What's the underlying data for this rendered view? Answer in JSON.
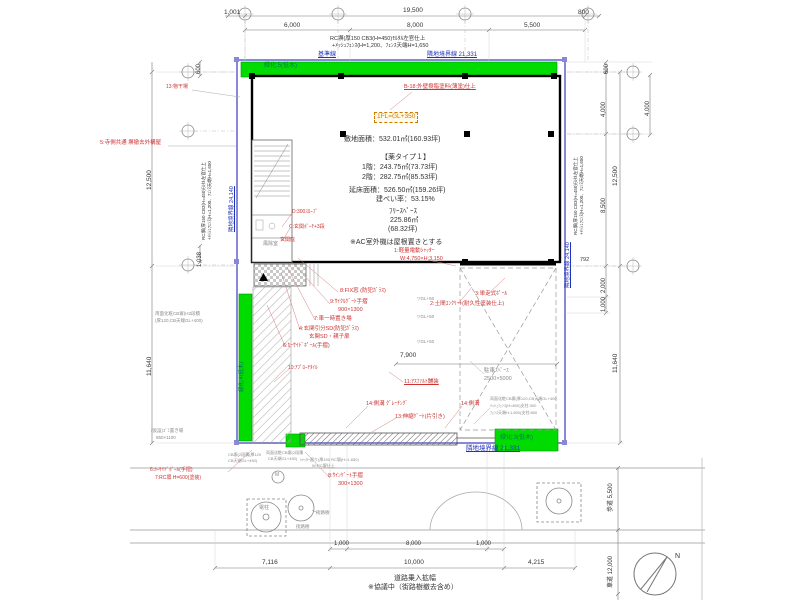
{
  "colors": {
    "ink": "#333333",
    "red": "#cc3333",
    "blue": "#2233bb",
    "teal": "#007755",
    "gray": "#8a8a8a",
    "orange": "#cc7a00",
    "green": "#00dc00",
    "green_edge": "#009900",
    "boundary": "#8888d8"
  },
  "plan_summary": {
    "site_area": "敷地面積：532.01㎡(160.93坪)",
    "plan_type": "【薬タイプ１】",
    "floor1": "1階：243.75㎡(73.73坪)",
    "floor2": "2階：282.75㎡(85.53坪)",
    "total_floor_area": "延床面積：526.50㎡(159.26坪)",
    "coverage_ratio": "建ぺい率：53.15%",
    "free_space": "ﾌﾘｰｽﾍﾟｰｽ 225.86㎡ (68.32坪)",
    "ac_note": "※AC室外機は屋根置きとする",
    "floor_level": "1FL=GL+350"
  },
  "labels": [
    {
      "n": "dim-top-1001",
      "t": "1,001",
      "x": 224,
      "y": 10,
      "s": 6.5
    },
    {
      "n": "dim-top-19500",
      "t": "19,500",
      "x": 403,
      "y": 8,
      "s": 6.5
    },
    {
      "n": "dim-top-800",
      "t": "800",
      "x": 578,
      "y": 10,
      "s": 6.5
    },
    {
      "n": "dim-top-6000",
      "t": "6,000",
      "x": 284,
      "y": 23,
      "s": 6.5
    },
    {
      "n": "dim-top-8000",
      "t": "8,000",
      "x": 407,
      "y": 23,
      "s": 6.5
    },
    {
      "n": "dim-top-5500",
      "t": "5,500",
      "x": 524,
      "y": 23,
      "s": 6.5
    },
    {
      "n": "note-wall-top-1",
      "t": "RC塀(厚150 CB3(H=450)ﾓﾙﾀﾙ左官仕上",
      "x": 330,
      "y": 37,
      "s": 5.5
    },
    {
      "n": "note-wall-top-2",
      "t": "+ﾒｯｼｭﾌｪﾝｽ(H=1,200、ﾌｪﾝｽ天端H=1,650",
      "x": 332,
      "y": 44,
      "s": 5.5
    },
    {
      "n": "label-baseline",
      "t": "基準線",
      "x": 318,
      "y": 52,
      "c": "blue",
      "s": 6,
      "u": 1
    },
    {
      "n": "label-boundary-top",
      "t": "隣地境界線 21,331",
      "x": 427,
      "y": 52,
      "c": "blue",
      "s": 6,
      "u": 1
    },
    {
      "n": "label-green-top",
      "t": "緑化:5(低木)",
      "x": 264,
      "y": 63,
      "c": "teal",
      "s": 6
    },
    {
      "n": "label-green-left",
      "t": "緑化:4(低木)",
      "x": 240,
      "y": 392,
      "c": "teal",
      "s": 5.5,
      "rot": 1
    },
    {
      "n": "label-green-br",
      "t": "緑化:3(低木)",
      "x": 500,
      "y": 435,
      "c": "teal",
      "s": 6
    },
    {
      "n": "text-site-area",
      "t": "敷地面積：532.01㎡(160.93坪)",
      "x": 344,
      "y": 136,
      "s": 7
    },
    {
      "n": "text-plan-type",
      "t": "【薬タイプ１】",
      "x": 381,
      "y": 154,
      "s": 7
    },
    {
      "n": "text-floor1",
      "t": "1階：243.75㎡(73.73坪)",
      "x": 362,
      "y": 164,
      "s": 7
    },
    {
      "n": "text-floor2",
      "t": "2階：282.75㎡(85.53坪)",
      "x": 362,
      "y": 174,
      "s": 7
    },
    {
      "n": "text-total-area",
      "t": "延床面積：526.50㎡(159.26坪)",
      "x": 349,
      "y": 187,
      "s": 7
    },
    {
      "n": "text-coverage",
      "t": "建ぺい率：53.15%",
      "x": 376,
      "y": 196,
      "s": 7
    },
    {
      "n": "text-free-space",
      "t": "ﾌﾘｰｽﾍﾟｰｽ",
      "x": 389,
      "y": 208,
      "s": 7
    },
    {
      "n": "text-free-area",
      "t": "225.86㎡",
      "x": 390,
      "y": 217,
      "s": 7
    },
    {
      "n": "text-free-tsubo",
      "t": "(68.32坪)",
      "x": 388,
      "y": 226,
      "s": 7
    },
    {
      "n": "text-ac-note",
      "t": "※AC室外機は屋根置きとする",
      "x": 350,
      "y": 239,
      "s": 7
    },
    {
      "n": "label-fl-level",
      "t": "1FL=GL+350",
      "x": 374,
      "y": 112,
      "c": "orange",
      "s": 6.5,
      "box": 1
    },
    {
      "n": "note-b18",
      "t": "B-18:外壁樹脂塗料(薄塗)仕上",
      "x": 404,
      "y": 85,
      "c": "red",
      "s": 5.5,
      "u": 1
    },
    {
      "n": "note-13-top",
      "t": "13:物干場",
      "x": 166,
      "y": 85,
      "c": "red",
      "s": 5
    },
    {
      "n": "note-5-temple",
      "t": "5:寺側共通 塀撤去外構屋",
      "x": 100,
      "y": 141,
      "c": "red",
      "s": 5.5
    },
    {
      "n": "note-d-slope",
      "t": "D:300ｽﾛｰﾌﾟ",
      "x": 292,
      "y": 210,
      "c": "red",
      "s": 5
    },
    {
      "n": "note-c-porch",
      "t": "C:玄関ﾎﾟｰﾁ+3段",
      "x": 289,
      "y": 225,
      "c": "red",
      "s": 5
    },
    {
      "n": "note-hisashi",
      "t": "玄関庇",
      "x": 280,
      "y": 238,
      "c": "red",
      "s": 5
    },
    {
      "n": "note-8-fix",
      "t": "8:FIX窓 (防犯ｶﾞﾗｽ)",
      "x": 340,
      "y": 289,
      "c": "red",
      "s": 5.5
    },
    {
      "n": "note-9-gate",
      "t": "9:ｻｲｸﾙｹﾞｰﾄ手摺",
      "x": 330,
      "y": 300,
      "c": "red",
      "s": 5.5
    },
    {
      "n": "note-9-size",
      "t": "900×1300",
      "x": 338,
      "y": 308,
      "c": "red",
      "s": 5.5
    },
    {
      "n": "note-7-car",
      "t": "7:車一時置き場",
      "x": 314,
      "y": 317,
      "c": "red",
      "s": 5.5
    },
    {
      "n": "note-4-door",
      "t": "4:玄関引分SD(防犯ｶﾞﾗｽ)",
      "x": 299,
      "y": 327,
      "c": "red",
      "s": 5.5
    },
    {
      "n": "note-4-door2",
      "t": "玄関SD・親子扉",
      "x": 309,
      "y": 335,
      "c": "red",
      "s": 5.5
    },
    {
      "n": "note-6-pole",
      "t": "6:ｶｰｻｲﾄﾞﾎﾟｰﾙ(手摺)",
      "x": 283,
      "y": 344,
      "c": "red",
      "s": 5.5
    },
    {
      "n": "note-1-shutter",
      "t": "1:軽量電動ｼｬｯﾀｰ",
      "x": 394,
      "y": 249,
      "c": "red",
      "s": 5.5
    },
    {
      "n": "note-1-size",
      "t": "W:4,750×H:3,150",
      "x": 400,
      "y": 257,
      "c": "red",
      "s": 5.5
    },
    {
      "n": "note-3-pole",
      "t": "3:単走式ﾎﾟｰﾙ",
      "x": 475,
      "y": 292,
      "c": "red",
      "s": 5.5
    },
    {
      "n": "note-2-concrete",
      "t": "2:土間ｺﾝｸﾘｰﾄ(耐久性塗装仕上)",
      "x": 430,
      "y": 302,
      "c": "red",
      "s": 5.5
    },
    {
      "n": "note-11-asphalt",
      "t": "11:ｱｽﾌｧﾙﾄ舗装",
      "x": 404,
      "y": 380,
      "c": "red",
      "s": 5.5,
      "u": 1
    },
    {
      "n": "note-10-tile",
      "t": "10:ｱﾌﾟﾛｰﾁﾀｲﾙ",
      "x": 288,
      "y": 366,
      "c": "red",
      "s": 5
    },
    {
      "n": "note-14-gutter-a",
      "t": "14:側溝 ｸﾞﾚｰﾁﾝｸﾞ",
      "x": 366,
      "y": 402,
      "c": "red",
      "s": 5.5
    },
    {
      "n": "note-13-gate",
      "t": "13:伸縮ｹﾞｰﾄ(片引き)",
      "x": 395,
      "y": 415,
      "c": "red",
      "s": 5.5
    },
    {
      "n": "note-14-gutter-b",
      "t": "14:側溝",
      "x": 461,
      "y": 402,
      "c": "red",
      "s": 5.5
    },
    {
      "n": "note-8-sign",
      "t": "8:ｻｲﾝｹﾞｰﾄ手摺",
      "x": 328,
      "y": 474,
      "c": "red",
      "s": 5.5
    },
    {
      "n": "note-8-sign-size",
      "t": "300×1300",
      "x": 338,
      "y": 482,
      "c": "red",
      "s": 5.5
    },
    {
      "n": "note-6-pole-b",
      "t": "6:ｶｰｻｲﾄﾞﾎﾟｰﾙ(手摺)",
      "x": 150,
      "y": 468,
      "c": "red",
      "s": 5
    },
    {
      "n": "note-7-rc",
      "t": "7:RC塀 H=600(塗装)",
      "x": 155,
      "y": 476,
      "c": "red",
      "s": 5
    },
    {
      "n": "gray-parking-1",
      "t": "駐車ｽﾍﾟｰｽ",
      "x": 484,
      "y": 369,
      "c": "gray",
      "s": 5.5
    },
    {
      "n": "gray-parking-2",
      "t": "2500×5000",
      "x": 484,
      "y": 377,
      "c": "gray",
      "s": 5.5
    },
    {
      "n": "gray-gl-1",
      "t": "▽GL+50",
      "x": 417,
      "y": 297,
      "c": "gray",
      "s": 4.5
    },
    {
      "n": "gray-gl-2",
      "t": "▽GL+50",
      "x": 417,
      "y": 315,
      "c": "gray",
      "s": 4.5
    },
    {
      "n": "gray-gl-3",
      "t": "▽GL+50",
      "x": 417,
      "y": 340,
      "c": "gray",
      "s": 4.5
    },
    {
      "n": "gray-cb-left-1",
      "t": "両面化粧CB塀(H2段積",
      "x": 155,
      "y": 312,
      "c": "gray",
      "s": 4.5
    },
    {
      "n": "gray-cb-left-2",
      "t": "(厚120,CB天端GL+400)",
      "x": 155,
      "y": 319,
      "c": "gray",
      "s": 4.5
    },
    {
      "n": "gray-trash-1",
      "t": "(仮設)ｺﾞﾐ置き場",
      "x": 151,
      "y": 429,
      "c": "gray",
      "s": 4.5
    },
    {
      "n": "gray-trash-2",
      "t": "850×1100",
      "x": 156,
      "y": 436,
      "c": "gray",
      "s": 4.5
    },
    {
      "n": "gray-cb-right-1",
      "t": "両面化粧CB塀(厚120,CB天端GL+400",
      "x": 490,
      "y": 397,
      "c": "gray",
      "s": 4
    },
    {
      "n": "gray-cb-right-2",
      "t": "ﾒｯｼｭﾌｪﾝｽ(H=800)支柱:300",
      "x": 490,
      "y": 404,
      "c": "gray",
      "s": 4
    },
    {
      "n": "gray-cb-right-3",
      "t": "ﾌｪﾝｽ天端H:1,650(支柱:850",
      "x": 490,
      "y": 411,
      "c": "gray",
      "s": 4
    },
    {
      "n": "gray-cb-bot-1a",
      "t": "CB塀(2段積(厚120",
      "x": 228,
      "y": 453,
      "c": "gray",
      "s": 4
    },
    {
      "n": "gray-cb-bot-1b",
      "t": "CB天端GL+450)",
      "x": 228,
      "y": 459,
      "c": "gray",
      "s": 4
    },
    {
      "n": "gray-cb-bot-2a",
      "t": "両面化粧CB塀(2段積",
      "x": 266,
      "y": 451,
      "c": "gray",
      "s": 4
    },
    {
      "n": "gray-cb-bot-2b",
      "t": "CB天端GL+450)",
      "x": 268,
      "y": 457,
      "c": "gray",
      "s": 4
    },
    {
      "n": "gray-cb-bot-3a",
      "t": "ｼｬｯﾀｰ廻り(厚150 RC塀(H=1,650)",
      "x": 300,
      "y": 458,
      "c": "gray",
      "s": 4
    },
    {
      "n": "gray-cb-bot-3b",
      "t": "W:RC塀仕上",
      "x": 312,
      "y": 464,
      "c": "gray",
      "s": 4
    },
    {
      "n": "label-fujo",
      "t": "風除室",
      "x": 263,
      "y": 242,
      "c": "gray",
      "s": 5
    },
    {
      "n": "dim-left-600",
      "t": "600",
      "x": 196,
      "y": 74,
      "s": 6,
      "rot": 1
    },
    {
      "n": "dim-left-12500",
      "t": "12,500",
      "x": 147,
      "y": 190,
      "s": 6.5,
      "rot": 1
    },
    {
      "n": "dim-left-1038",
      "t": "1,038",
      "x": 197,
      "y": 267,
      "s": 6,
      "rot": 1
    },
    {
      "n": "dim-left-11640",
      "t": "11,640",
      "x": 147,
      "y": 376,
      "s": 6.5,
      "rot": 1
    },
    {
      "n": "note-wall-left-1",
      "t": "RC塀(厚150 CB3(H=450)ﾓﾙﾀﾙ左官仕上",
      "x": 202,
      "y": 240,
      "s": 4.5,
      "rot": 1
    },
    {
      "n": "note-wall-left-2",
      "t": "+ﾒｯｼｭﾌｪﾝｽ(H=1,200、ﾌｪﾝｽ天端H=1,650",
      "x": 208,
      "y": 240,
      "s": 4.5,
      "rot": 1
    },
    {
      "n": "label-boundary-left",
      "t": "隣地境界線 24,140",
      "x": 230,
      "y": 232,
      "c": "blue",
      "s": 5.5,
      "rot": 1,
      "u": 1
    },
    {
      "n": "dim-right-600",
      "t": "600",
      "x": 604,
      "y": 74,
      "s": 6,
      "rot": 1
    },
    {
      "n": "dim-right-4000",
      "t": "4,000",
      "x": 601,
      "y": 117,
      "s": 6,
      "rot": 1
    },
    {
      "n": "dim-right-12500",
      "t": "12,500",
      "x": 613,
      "y": 186,
      "s": 6.5,
      "rot": 1
    },
    {
      "n": "dim-right-8500",
      "t": "8,500",
      "x": 601,
      "y": 213,
      "s": 6,
      "rot": 1
    },
    {
      "n": "dim-right-792",
      "t": "792",
      "x": 580,
      "y": 258,
      "s": 5.5
    },
    {
      "n": "dim-right-2000",
      "t": "2,000",
      "x": 601,
      "y": 293,
      "s": 6,
      "rot": 1
    },
    {
      "n": "dim-right-1000",
      "t": "1,000",
      "x": 601,
      "y": 312,
      "s": 6,
      "rot": 1
    },
    {
      "n": "dim-right-11640",
      "t": "11,640",
      "x": 613,
      "y": 373,
      "s": 6.5,
      "rot": 1
    },
    {
      "n": "dim-far-right-4000",
      "t": "4.000",
      "x": 645,
      "y": 116,
      "s": 6,
      "rot": 1
    },
    {
      "n": "note-wall-right-1",
      "t": "RC塀(厚150 CB3(H=450)ﾓﾙﾀﾙ左官仕上",
      "x": 574,
      "y": 235,
      "s": 4.5,
      "rot": 1
    },
    {
      "n": "note-wall-right-2",
      "t": "+ﾒｯｼｭﾌｪﾝｽ(H=1,200、ﾌｪﾝｽ天端H=1,650",
      "x": 580,
      "y": 235,
      "s": 4.5,
      "rot": 1
    },
    {
      "n": "label-boundary-right",
      "t": "隣地境界線 24,140",
      "x": 566,
      "y": 288,
      "c": "blue",
      "s": 5.5,
      "rot": 1,
      "u": 1
    },
    {
      "n": "label-boundary-bottom",
      "t": "隣地境界線 21,331",
      "x": 466,
      "y": 446,
      "c": "blue",
      "s": 6.5,
      "u": 1
    },
    {
      "n": "dim-yard-7900",
      "t": "7,900",
      "x": 400,
      "y": 353,
      "s": 6.5
    },
    {
      "n": "dim-bot-1000a",
      "t": "1,000",
      "x": 334,
      "y": 541,
      "s": 6
    },
    {
      "n": "dim-bot-8000",
      "t": "8,000",
      "x": 406,
      "y": 541,
      "s": 6
    },
    {
      "n": "dim-bot-1000b",
      "t": "1,000",
      "x": 476,
      "y": 541,
      "s": 6
    },
    {
      "n": "dim-bot-7116",
      "t": "7,116",
      "x": 262,
      "y": 560,
      "s": 6.5
    },
    {
      "n": "dim-bot-10000",
      "t": "10,000",
      "x": 404,
      "y": 560,
      "s": 6.5
    },
    {
      "n": "dim-bot-4215",
      "t": "4,215",
      "x": 528,
      "y": 560,
      "s": 6.5
    },
    {
      "n": "label-road-widen",
      "t": "道路乗入拡幅",
      "x": 394,
      "y": 575,
      "s": 7
    },
    {
      "n": "label-road-note",
      "t": "※協議中（街路樹撤去含め）",
      "x": 368,
      "y": 584,
      "s": 7
    },
    {
      "n": "label-sidewalk",
      "t": "歩道 5,500",
      "x": 608,
      "y": 512,
      "s": 6,
      "rot": 1
    },
    {
      "n": "label-roadway",
      "t": "車道 12,000",
      "x": 608,
      "y": 588,
      "s": 6,
      "rot": 1
    },
    {
      "n": "label-north",
      "t": "N",
      "x": 675,
      "y": 553,
      "s": 7
    },
    {
      "n": "label-denchu",
      "t": "電柱",
      "x": 259,
      "y": 506,
      "c": "gray",
      "s": 5
    },
    {
      "n": "label-tree-1",
      "t": "街路樹",
      "x": 316,
      "y": 511,
      "c": "gray",
      "s": 4.5
    },
    {
      "n": "label-tree-2",
      "t": "街路樹",
      "x": 296,
      "y": 525,
      "c": "gray",
      "s": 4.5
    },
    {
      "n": "label-meter-m",
      "t": "M",
      "x": 275,
      "y": 473,
      "c": "gray",
      "s": 5
    }
  ]
}
